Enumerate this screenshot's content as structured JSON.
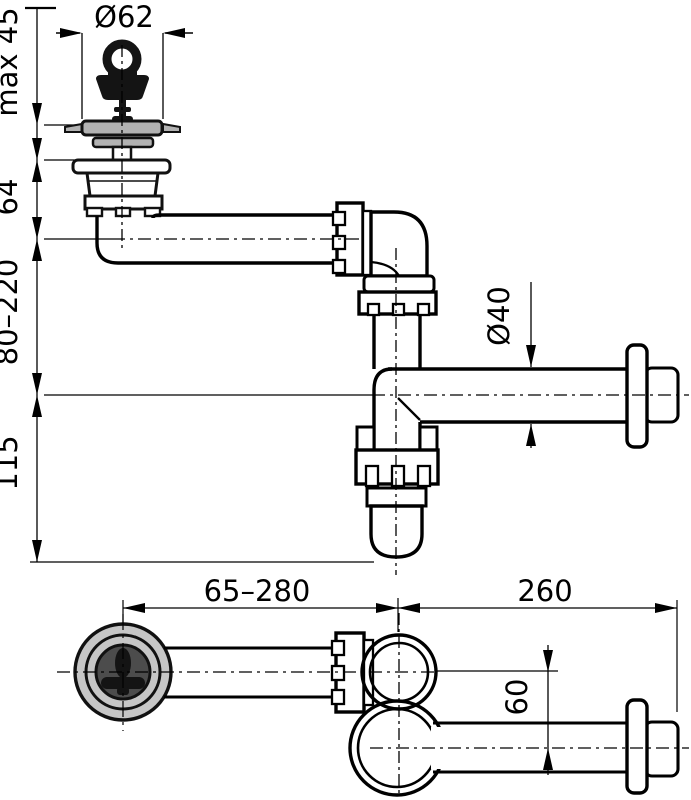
{
  "title": "Sink bottle-trap siphon installation drawing",
  "side_view": {
    "plug_diameter": "Ø62",
    "max_deck_thickness": "max 45",
    "drain_body_height": "64",
    "inlet_height_range": "80–220",
    "trap_depth": "115",
    "pipe_diameter": "Ø40"
  },
  "plan_view": {
    "inlet_length_range": "65–280",
    "outlet_length": "260",
    "centerline_offset": "60"
  },
  "colors": {
    "line": "#000000",
    "background": "#ffffff",
    "light_gray": "#c6c6c6",
    "mid_gray": "#b2b2b2",
    "dark_gray": "#4c4c4c",
    "plug_black": "#141414"
  }
}
